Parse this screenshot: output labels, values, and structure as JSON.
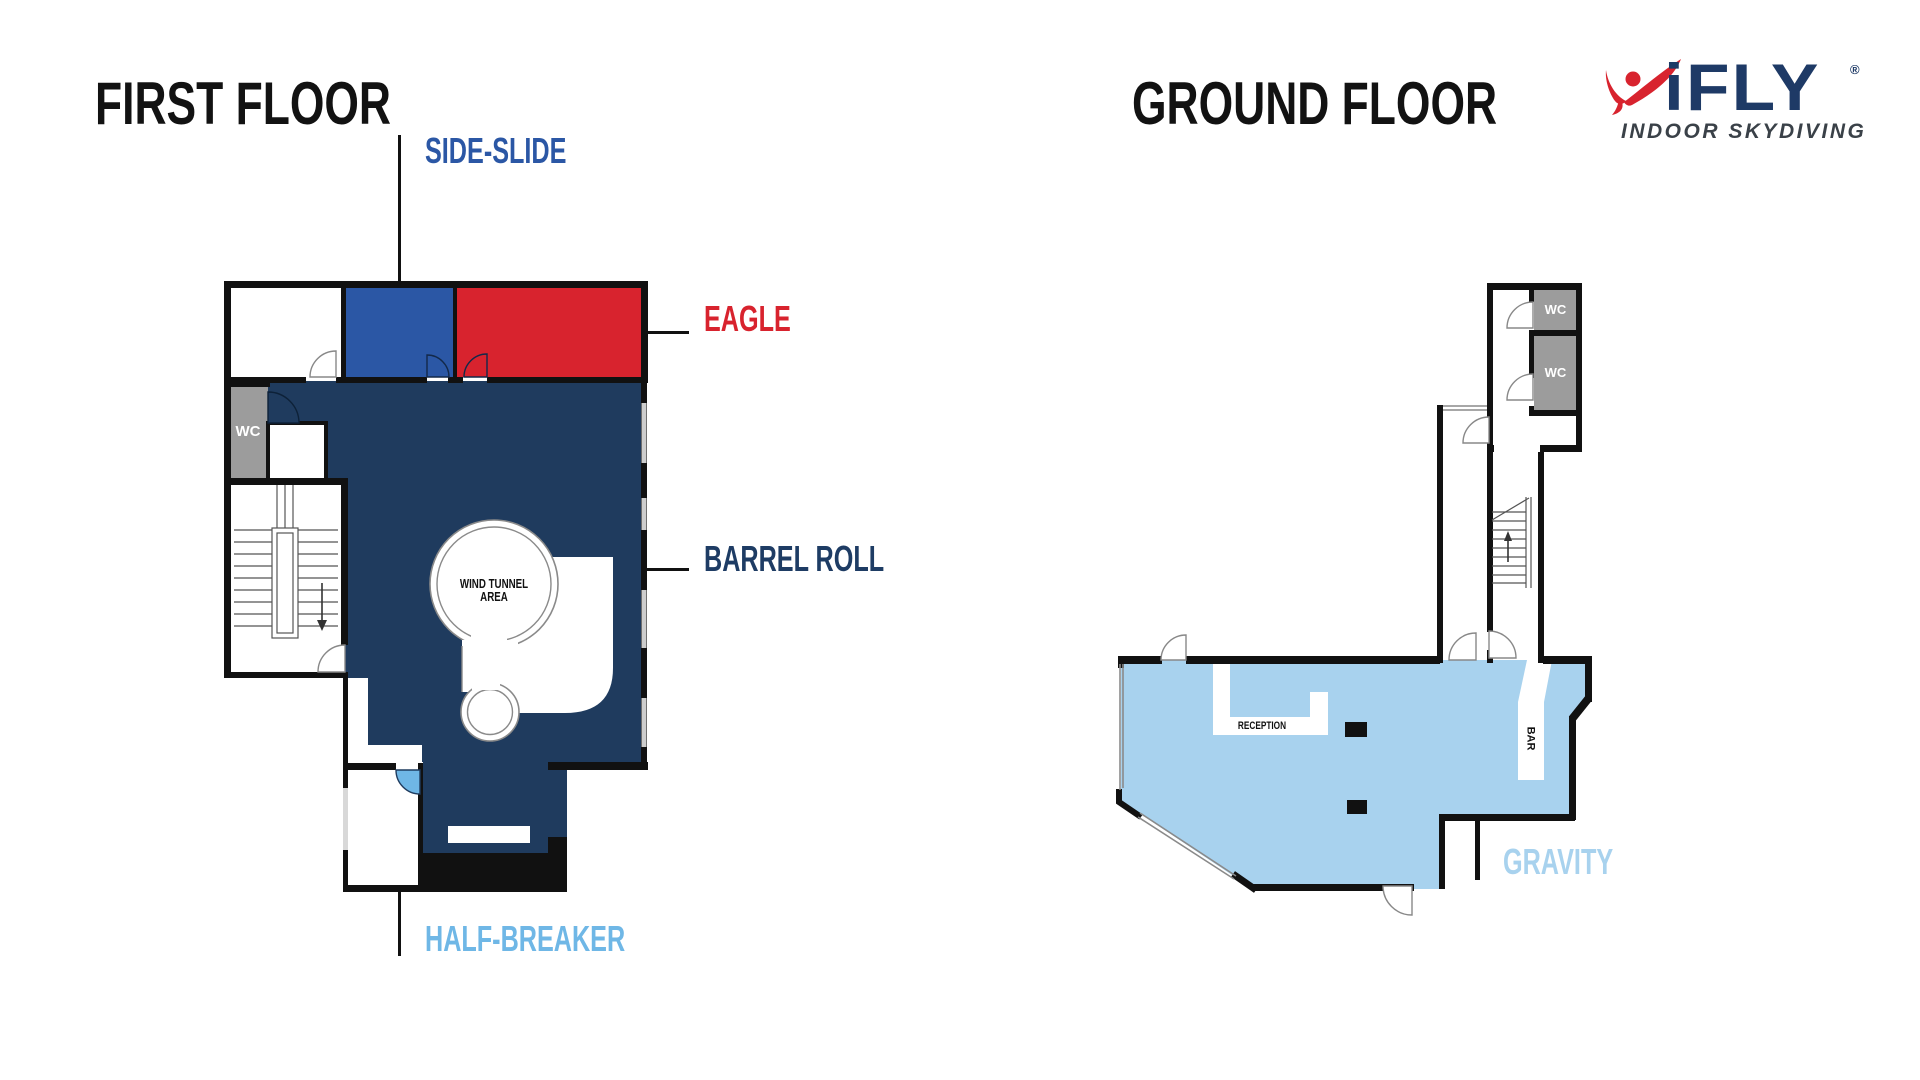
{
  "first_floor": {
    "title": "FIRST FLOOR",
    "callouts": {
      "side_slide": "SIDE-SLIDE",
      "eagle": "EAGLE",
      "barrel_roll": "BARREL ROLL",
      "half_breaker": "HALF-BREAKER"
    },
    "rooms": {
      "wind_tunnel": "WIND TUNNEL AREA",
      "wc": "WC"
    }
  },
  "ground_floor": {
    "title": "GROUND FLOOR",
    "callouts": {
      "gravity": "GRAVITY"
    },
    "rooms": {
      "reception": "RECEPTION",
      "bar": "BAR",
      "wc_upper": "WC",
      "wc_lower": "WC"
    }
  },
  "logo": {
    "brand": "iFLY",
    "registered": "®",
    "tagline": "INDOOR SKYDIVING"
  },
  "colors": {
    "navy_fill": "#1F3B5E",
    "blue_room": "#2B57A5",
    "red_room": "#D8232E",
    "sky_blue": "#6FB7E6",
    "pale_blue": "#A8D2EE",
    "wc_gray": "#9C9C9C",
    "wall_black": "#111111",
    "callout_blue": "#2B57A5",
    "callout_red": "#D8232E",
    "callout_navy": "#1E3C64",
    "logo_navy": "#1E3A66",
    "logo_red": "#D8232E",
    "tagline_gray": "#3A4148"
  }
}
